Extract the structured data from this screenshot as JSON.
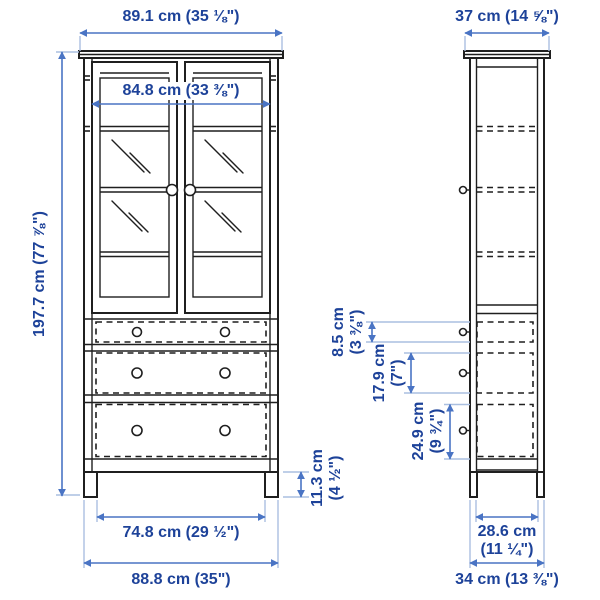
{
  "colors": {
    "dimension_text": "#1d4299",
    "dimension_line": "#4a74c4",
    "extension_line": "#aabfe0",
    "drawing_line": "#1f1f1f",
    "background": "#ffffff"
  },
  "dimensions": {
    "front_overall_width": {
      "metric": "89.1 cm",
      "imperial": "(35 ⅛\")"
    },
    "front_inner_width": {
      "metric": "84.8 cm",
      "imperial": "(33 ⅜\")"
    },
    "overall_height": {
      "metric": "197.7 cm",
      "imperial": "(77 ⅞\")"
    },
    "overall_depth": {
      "metric": "37 cm",
      "imperial": "(14 ⅝\")"
    },
    "top_drawer_height": {
      "metric": "8.5 cm",
      "imperial": "(3 ⅜\")"
    },
    "middle_drawer_height": {
      "metric": "17.9 cm",
      "imperial": "(7\")"
    },
    "bottom_drawer_height": {
      "metric": "24.9 cm",
      "imperial": "(9 ¾\")"
    },
    "leg_height": {
      "metric": "11.3 cm",
      "imperial": "(4 ½\")"
    },
    "inner_base_width": {
      "metric": "74.8 cm",
      "imperial": "(29 ½\")"
    },
    "overall_base_width": {
      "metric": "88.8 cm",
      "imperial": "(35\")"
    },
    "inner_base_depth": {
      "metric": "28.6 cm",
      "imperial": "(11 ¼\")"
    },
    "overall_base_depth": {
      "metric": "34 cm",
      "imperial": "(13 ⅜\")"
    }
  }
}
